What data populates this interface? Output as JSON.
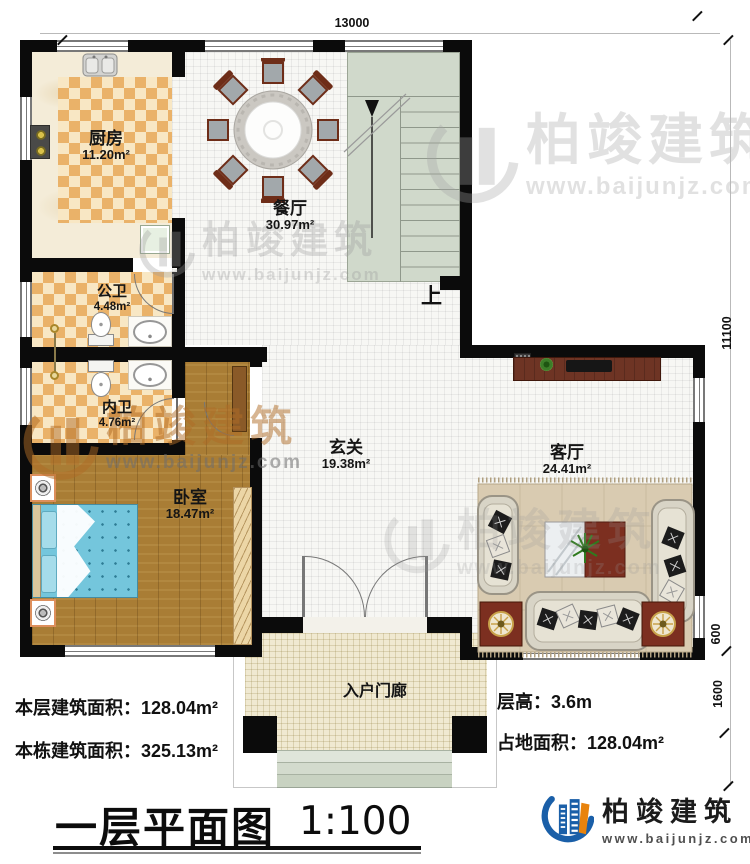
{
  "plan": {
    "dims": {
      "top": "13000",
      "right": "11100",
      "s600": "600",
      "s1600": "1600"
    },
    "rooms": [
      {
        "name": "厨房",
        "area": "11.20m²"
      },
      {
        "name": "餐厅",
        "area": "30.97m²"
      },
      {
        "name": "公卫",
        "area": "4.48m²"
      },
      {
        "name": "内卫",
        "area": "4.76m²"
      },
      {
        "name": "卧室",
        "area": "18.47m²"
      },
      {
        "name": "玄关",
        "area": "19.38m²"
      },
      {
        "name": "客厅",
        "area": "24.41m²"
      },
      {
        "name": "入户门廊",
        "area": ""
      }
    ],
    "stair_up": "上"
  },
  "stats": {
    "line1": "本层建筑面积：128.04m²",
    "line2": "本栋建筑面积：325.13m²",
    "line3": "层高：3.6m",
    "line4": "占地面积：128.04m²"
  },
  "title": {
    "text": "一层平面图",
    "scale": "1:100"
  },
  "brand": {
    "name": "柏竣建筑",
    "site": "www.baijunjz.com"
  }
}
